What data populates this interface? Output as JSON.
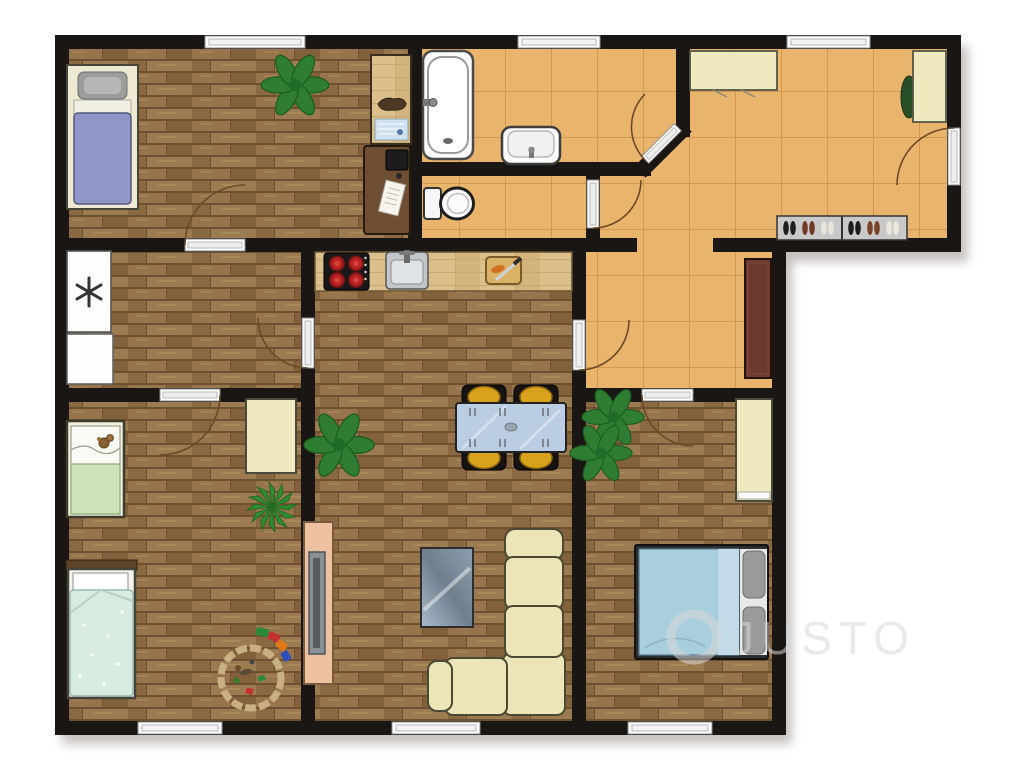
{
  "watermark": {
    "text": "JUSTO",
    "logo": "circle-outline"
  },
  "colors": {
    "wall": "#191613",
    "woodBase": "#8a6a44",
    "tileBase": "#e9b46c",
    "tileLine": "#d29750",
    "sofa": "#ece5b8",
    "chairGold": "#d8a21d",
    "glassTable": "#bacde3",
    "bedBlue": "#a9cede",
    "bedPurple": "#9196c8",
    "bedGreen": "#cde4bb",
    "bedMint": "#d9ece2",
    "wardrobe": "#efe9c0",
    "counter": "#dcc08c",
    "sideboard": "#eec2a0",
    "rug": "#6e3a30",
    "plant": "#2f7d33",
    "watermark": "#d8d8d8"
  },
  "plan": {
    "type": "apartment-floor-plan",
    "rooms": [
      {
        "id": "bedroom-top-left",
        "floor": "wood",
        "items": [
          "single-bed",
          "gray-pillow",
          "purple-blanket",
          "leafy-plant",
          "light-desk",
          "blueprint",
          "dark-desk",
          "monitor",
          "papers",
          "window",
          "door"
        ]
      },
      {
        "id": "bathroom",
        "floor": "tile",
        "items": [
          "bathtub",
          "wash-basin",
          "window",
          "diagonal-door"
        ]
      },
      {
        "id": "wc",
        "floor": "tile",
        "items": [
          "toilet",
          "door"
        ]
      },
      {
        "id": "entrance-hall",
        "floor": "tile",
        "items": [
          "cabinet-top",
          "cabinet-right",
          "small-plant",
          "shoe-rack",
          "shoes",
          "entrance-door",
          "window"
        ]
      },
      {
        "id": "lower-hallway",
        "floor": "tile",
        "items": [
          "runner-rug",
          "door-to-living",
          "door-to-bedroom"
        ]
      },
      {
        "id": "storage-room",
        "floor": "wood",
        "items": [
          "fridge-freezer",
          "white-appliance",
          "door"
        ]
      },
      {
        "id": "kids-room",
        "floor": "wood",
        "items": [
          "green-bed",
          "teddy-bear",
          "mint-bed",
          "wardrobe",
          "agave-plant",
          "toy-ring",
          "toy-train",
          "window",
          "door"
        ]
      },
      {
        "id": "kitchen-living-room",
        "floor": "wood",
        "items": [
          "stove",
          "kitchen-sink",
          "cutting-board",
          "knife",
          "carrot",
          "dining-table",
          "chairs-4",
          "leafy-plant",
          "tv-sideboard",
          "tv-panel",
          "glass-coffee-table",
          "corner-sofa",
          "window"
        ]
      },
      {
        "id": "bedroom-bottom-right",
        "floor": "wood",
        "items": [
          "double-bed",
          "gray-pillows",
          "wardrobe",
          "leafy-plants-2",
          "window",
          "door"
        ]
      }
    ]
  }
}
